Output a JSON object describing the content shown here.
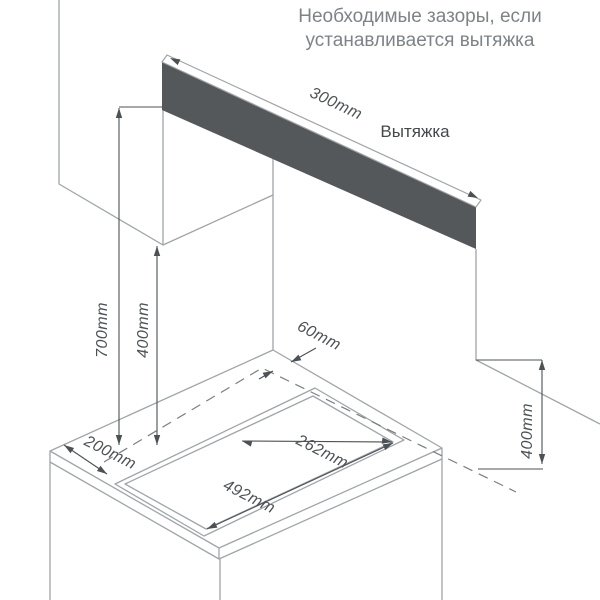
{
  "title": {
    "line1": "Необходимые зазоры, если",
    "line2": "устанавливается вытяжка"
  },
  "labels": {
    "hood": "Вытяжка"
  },
  "dimensions": {
    "hood_width": {
      "label": "300mm"
    },
    "hob_to_hood": {
      "label": "700mm"
    },
    "hob_to_wall_left": {
      "label": "400mm"
    },
    "back_gap": {
      "label": "60mm"
    },
    "side_clearance": {
      "label": "200mm"
    },
    "cutout_depth": {
      "label": "262mm"
    },
    "cutout_width": {
      "label": "492mm"
    },
    "wall_clearance_right": {
      "label": "400mm"
    }
  },
  "colors": {
    "bg": "#ffffff",
    "structure-line": "#a0a5a9",
    "dimension-line": "#4c5155",
    "dashed-line": "#7a7f83",
    "dim-text": "#4d5256",
    "title-text": "#7e8387",
    "hood-label-text": "#44484b",
    "hood-fill": "#54585b"
  }
}
